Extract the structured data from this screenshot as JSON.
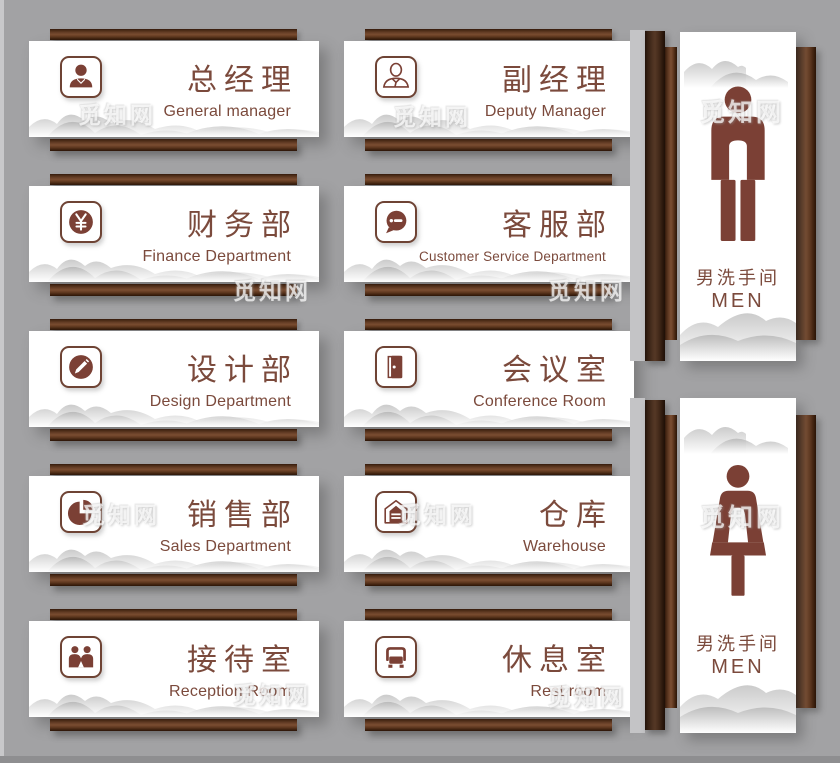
{
  "board": {
    "background": "#a2a2a4",
    "wood_dark": "#33190c",
    "wood_light": "#7a4d31",
    "panel_color": "#ffffff",
    "accent_text_color": "#7b4a3c",
    "icon_color": "#7b4035"
  },
  "watermark": "觅知网",
  "signs": [
    {
      "icon": "person-filled-icon",
      "icon_ref": "#i-manager",
      "title_zh": "总经理",
      "title_en": "General manager"
    },
    {
      "icon": "person-outline-icon",
      "icon_ref": "#i-deputy",
      "title_zh": "副经理",
      "title_en": "Deputy Manager"
    },
    {
      "icon": "yen-coin-icon",
      "icon_ref": "#i-finance",
      "title_zh": "财务部",
      "title_en": "Finance Department"
    },
    {
      "icon": "chat-bubble-icon",
      "icon_ref": "#i-service",
      "title_zh": "客服部",
      "title_en": "Customer Service Department"
    },
    {
      "icon": "pencil-icon",
      "icon_ref": "#i-design",
      "title_zh": "设计部",
      "title_en": "Design Department"
    },
    {
      "icon": "open-door-icon",
      "icon_ref": "#i-door",
      "title_zh": "会议室",
      "title_en": "Conference Room"
    },
    {
      "icon": "pie-chart-icon",
      "icon_ref": "#i-pie",
      "title_zh": "销售部",
      "title_en": "Sales Department"
    },
    {
      "icon": "warehouse-icon",
      "icon_ref": "#i-warehouse",
      "title_zh": "仓库",
      "title_en": "Warehouse"
    },
    {
      "icon": "handshake-icon",
      "icon_ref": "#i-reception",
      "title_zh": "接待室",
      "title_en": "Reception Room"
    },
    {
      "icon": "armchair-icon",
      "icon_ref": "#i-rest",
      "title_zh": "休息室",
      "title_en": "Rest room"
    }
  ],
  "restrooms": [
    {
      "icon": "male-figure-icon",
      "title_zh": "男洗手间",
      "title_en": "MEN"
    },
    {
      "icon": "female-figure-icon",
      "title_zh": "男洗手间",
      "title_en": "MEN"
    }
  ]
}
